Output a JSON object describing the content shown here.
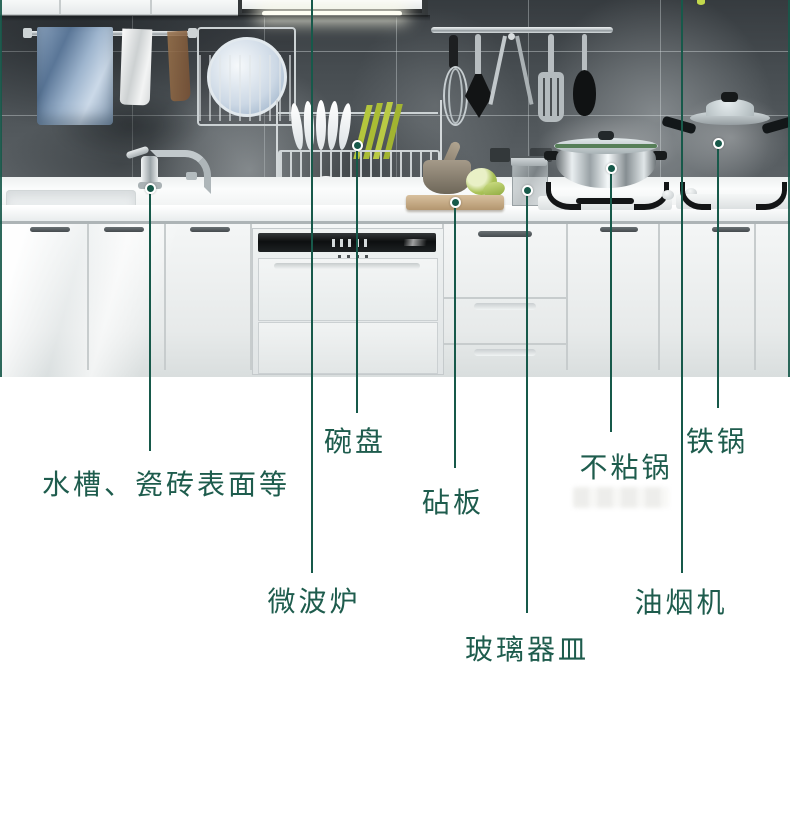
{
  "colors": {
    "accent_line": "#17594a",
    "label_text": "#1e5c4d",
    "dot_ring": "#ffffff",
    "background": "#ffffff"
  },
  "callouts": [
    {
      "name": "sink-tile-surfaces",
      "label": "水槽、瓷砖表面等",
      "line_x": 150,
      "line_top": 188,
      "line_bottom": 451,
      "dot_y": 188,
      "label_x": 166,
      "label_y": 471
    },
    {
      "name": "dishes",
      "label": "碗盘",
      "line_x": 357,
      "line_top": 145,
      "line_bottom": 413,
      "dot_y": 145,
      "label_x": 355,
      "label_y": 428
    },
    {
      "name": "microwave",
      "label": "微波炉",
      "line_x": 312,
      "line_top": 0,
      "line_bottom": 573,
      "dot_y": null,
      "label_x": 314,
      "label_y": 588
    },
    {
      "name": "cutting-board",
      "label": "砧板",
      "line_x": 455,
      "line_top": 202,
      "line_bottom": 468,
      "dot_y": 202,
      "label_x": 453,
      "label_y": 489
    },
    {
      "name": "glassware",
      "label": "玻璃器皿",
      "line_x": 527,
      "line_top": 190,
      "line_bottom": 613,
      "dot_y": 190,
      "label_x": 527,
      "label_y": 636
    },
    {
      "name": "nonstick-pan",
      "label": "不粘锅",
      "line_x": 611,
      "line_top": 168,
      "line_bottom": 432,
      "dot_y": 168,
      "label_x": 626,
      "label_y": 454
    },
    {
      "name": "range-hood",
      "label": "油烟机",
      "line_x": 682,
      "line_top": 0,
      "line_bottom": 573,
      "dot_y": null,
      "label_x": 681,
      "label_y": 589
    },
    {
      "name": "iron-pot",
      "label": "铁锅",
      "line_x": 718,
      "line_top": 143,
      "line_bottom": 408,
      "dot_y": 143,
      "label_x": 717,
      "label_y": 428
    }
  ]
}
